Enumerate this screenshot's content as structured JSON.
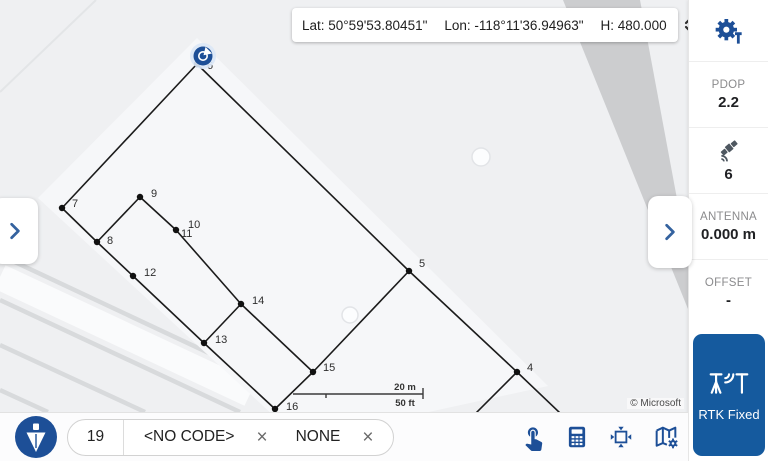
{
  "theme": {
    "icon_blue": "#1d4f97",
    "button_blue": "#155a9e",
    "map_bg": "#eff0f2",
    "road_gray": "#c5c7c9",
    "label_gray": "#8b8b8d",
    "text_dark": "#202124",
    "sat_gray": "#4e5760",
    "survey_black": "#1b1b1b"
  },
  "top_bar": {
    "lat": "Lat: 50°59'53.80451\"",
    "lon": "Lon: -118°11'36.94963\"",
    "h": "H: 480.000"
  },
  "sidebar": {
    "pdop_label": "PDOP",
    "pdop_value": "2.2",
    "satellites_value": "6",
    "antenna_label": "ANTENNA",
    "antenna_value": "0.000 m",
    "offset_label": "OFFSET",
    "offset_value": "-",
    "rtk_button": "RTK Fixed"
  },
  "bottom_bar": {
    "point_number": "19",
    "code": "<NO CODE>",
    "code_remove": "×",
    "attribute": "NONE",
    "attribute_remove": "×"
  },
  "map": {
    "attribution": "© Microsoft",
    "scale": {
      "metric": "20 m",
      "imperial": "50 ft"
    },
    "gps_marker": {
      "x": 203,
      "y": 56
    },
    "poi": [
      {
        "x": 481,
        "y": 157,
        "r": 9
      },
      {
        "x": 350,
        "y": 315,
        "r": 8
      }
    ],
    "points": [
      {
        "id": "4",
        "x": 517,
        "y": 372,
        "lx": 527,
        "ly": 371
      },
      {
        "id": "5",
        "x": 409,
        "y": 271,
        "lx": 419,
        "ly": 267
      },
      {
        "id": "6",
        "x": 197,
        "y": 64,
        "lx": 207,
        "ly": 69
      },
      {
        "id": "7",
        "x": 62,
        "y": 208,
        "lx": 72,
        "ly": 207
      },
      {
        "id": "8",
        "x": 97,
        "y": 242,
        "lx": 107,
        "ly": 244
      },
      {
        "id": "9",
        "x": 140,
        "y": 197,
        "lx": 151,
        "ly": 197
      },
      {
        "id": "10",
        "x": 178,
        "y": 226,
        "dot": false,
        "lx": 188,
        "ly": 228
      },
      {
        "id": "11",
        "x": 176,
        "y": 230,
        "lx": 181,
        "ly": 237
      },
      {
        "id": "12",
        "x": 133,
        "y": 276,
        "lx": 144,
        "ly": 276
      },
      {
        "id": "13",
        "x": 204,
        "y": 343,
        "lx": 215,
        "ly": 343
      },
      {
        "id": "14",
        "x": 241,
        "y": 304,
        "lx": 252,
        "ly": 304
      },
      {
        "id": "15",
        "x": 313,
        "y": 372,
        "lx": 323,
        "ly": 371
      },
      {
        "id": "16",
        "x": 275,
        "y": 409,
        "lx": 286,
        "ly": 410
      }
    ],
    "edges": [
      [
        "6",
        "7"
      ],
      [
        "7",
        "8"
      ],
      [
        "8",
        "9"
      ],
      [
        "9",
        "11"
      ],
      [
        "8",
        "12"
      ],
      [
        "12",
        "13"
      ],
      [
        "11",
        "14"
      ],
      [
        "13",
        "14"
      ],
      [
        "13",
        "16"
      ],
      [
        "14",
        "15"
      ],
      [
        "16",
        "15"
      ],
      [
        "15",
        "5"
      ],
      [
        "6",
        "5"
      ],
      [
        "5",
        "4"
      ]
    ],
    "tails": [
      {
        "x1": 517,
        "y1": 372,
        "x2": 476,
        "y2": 413
      },
      {
        "x1": 517,
        "y1": 372,
        "x2": 560,
        "y2": 413
      }
    ]
  }
}
